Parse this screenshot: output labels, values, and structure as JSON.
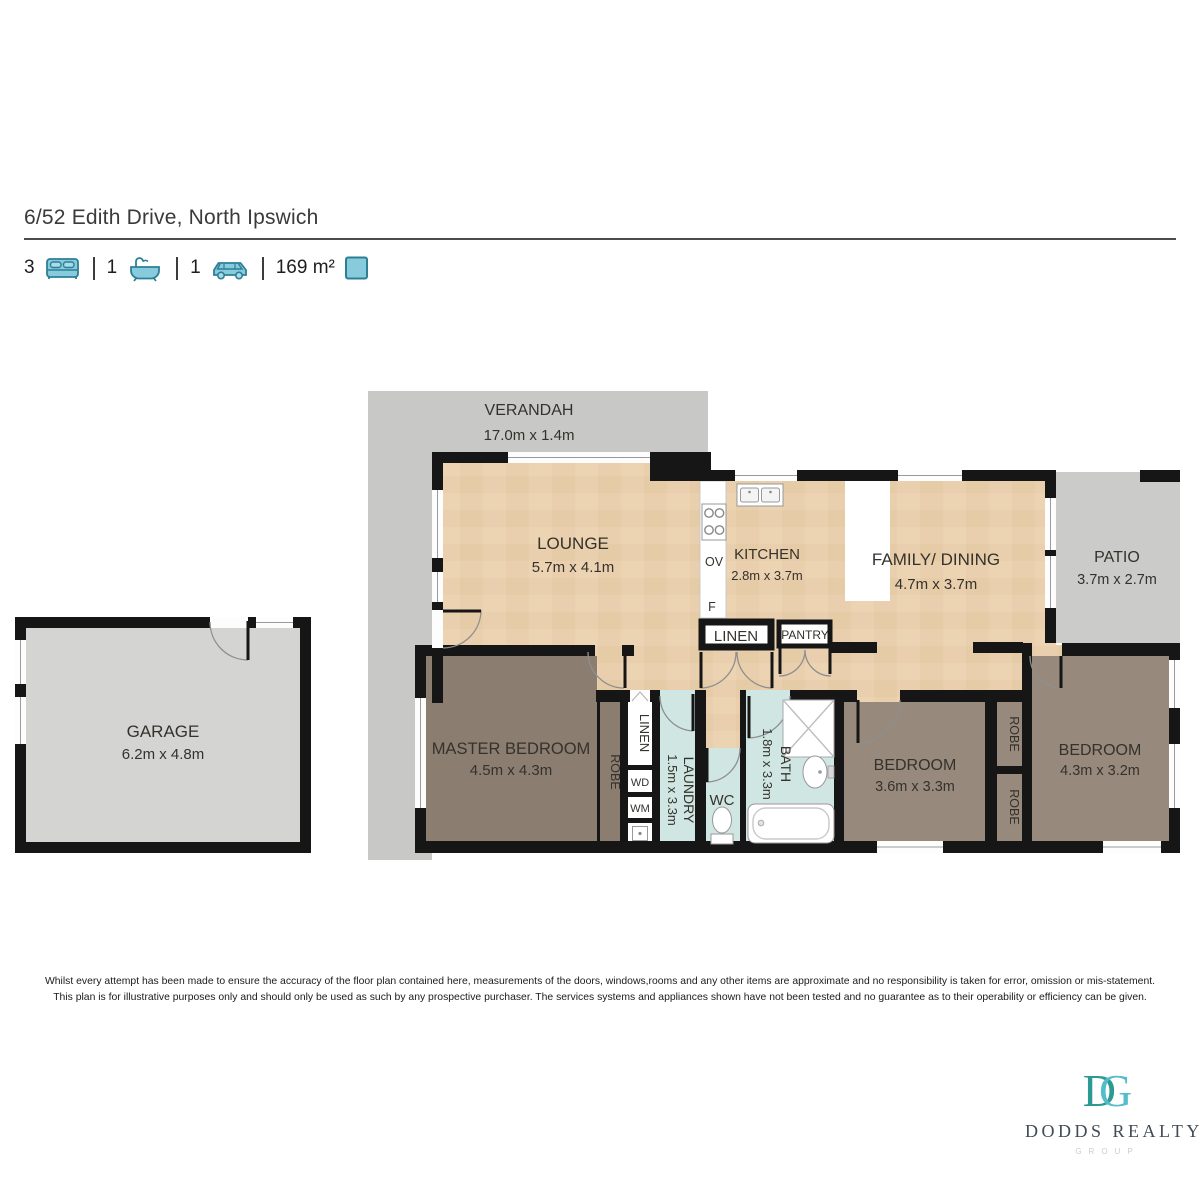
{
  "header": {
    "title": "6/52 Edith Drive, North Ipswich",
    "stats": [
      {
        "icon": "bed-icon",
        "value": "3"
      },
      {
        "icon": "bath-icon",
        "value": "1"
      },
      {
        "icon": "car-icon",
        "value": "1"
      },
      {
        "icon": "area-icon",
        "value": "169 m²"
      }
    ]
  },
  "plan": {
    "rooms": {
      "verandah": {
        "name": "VERANDAH",
        "dims": "17.0m x 1.4m"
      },
      "lounge": {
        "name": "LOUNGE",
        "dims": "5.7m x 4.1m"
      },
      "kitchen": {
        "name": "KITCHEN",
        "dims": "2.8m x 3.7m"
      },
      "family_dining": {
        "name": "FAMILY/ DINING",
        "dims": "4.7m x 3.7m"
      },
      "patio": {
        "name": "PATIO",
        "dims": "3.7m x 2.7m"
      },
      "garage": {
        "name": "GARAGE",
        "dims": "6.2m x 4.8m"
      },
      "master_bedroom": {
        "name": "MASTER BEDROOM",
        "dims": "4.5m x 4.3m"
      },
      "bedroom2": {
        "name": "BEDROOM",
        "dims": "3.6m x 3.3m"
      },
      "bedroom3": {
        "name": "BEDROOM",
        "dims": "4.3m x 3.2m"
      },
      "laundry": {
        "name": "LAUNDRY",
        "dims": "1.5m x 3.3m"
      },
      "bath": {
        "name": "BATH",
        "dims": "1.8m x 3.3m"
      },
      "wc": {
        "name": "WC"
      }
    },
    "labels": {
      "linen_closet": "LINEN",
      "linen_hall": "LINEN",
      "pantry": "PANTRY",
      "robe_master": "ROBE",
      "robe_bed2": "ROBE",
      "robe_bed3": "ROBE",
      "oven": "OV",
      "fridge": "F",
      "dryer": "WD",
      "washer": "WM"
    },
    "colors": {
      "wall": "#161616",
      "timber_floor": "#e9cfad",
      "master_brown": "#8b7d70",
      "bedroom_brown": "#97897b",
      "wet_area_blue": "#cfe6e2",
      "outdoor_grey": "#c8c8c6",
      "patio_grey": "#cbcbc9",
      "garage_grey": "#d4d4d2",
      "stat_icon_fill": "#87cbdd",
      "stat_icon_stroke": "#2d7f96"
    }
  },
  "disclaimer": {
    "line1": "Whilst every attempt has been made to ensure the accuracy of the floor plan contained here, measurements of the doors, windows,rooms and any other items are approximate and no responsibility is taken for error, omission or mis-statement.",
    "line2": "This plan is for illustrative purposes only and should only be used as such by any prospective purchaser. The services systems and appliances shown have not been tested and no guarantee as to their operability or efficiency can be given."
  },
  "logo": {
    "monogram_d": "D",
    "monogram_g": "G",
    "name": "DODDS REALTY",
    "group": "GROUP"
  }
}
